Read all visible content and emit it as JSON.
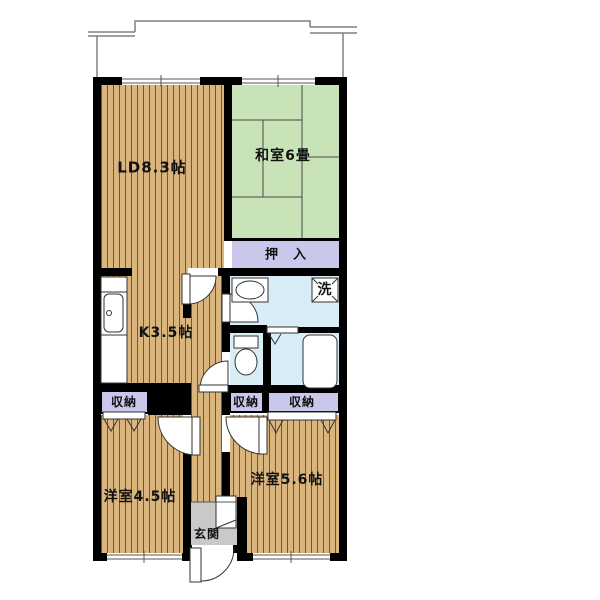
{
  "floorplan": {
    "rooms": {
      "living_dining": "LD8.3帖",
      "japanese_room": "和室6畳",
      "closet_oshiire": "押　入",
      "washing_machine": "洗",
      "kitchen": "K3.5帖",
      "storage_left": "収納",
      "storage_middle": "収納",
      "storage_right": "収納",
      "western_room_small": "洋室4.5帖",
      "western_room_large": "洋室5.6帖",
      "entrance": "玄関"
    },
    "colors": {
      "wood": "#DBB57E",
      "wood_stripe": "#77552E",
      "tatami": "#C7E3B7",
      "closet_purple": "#C9C8EC",
      "wet_area_blue": "#D9EDF7",
      "entrance_gray": "#C9C9C9",
      "wall": "#000000",
      "balcony_line": "#808080"
    }
  }
}
